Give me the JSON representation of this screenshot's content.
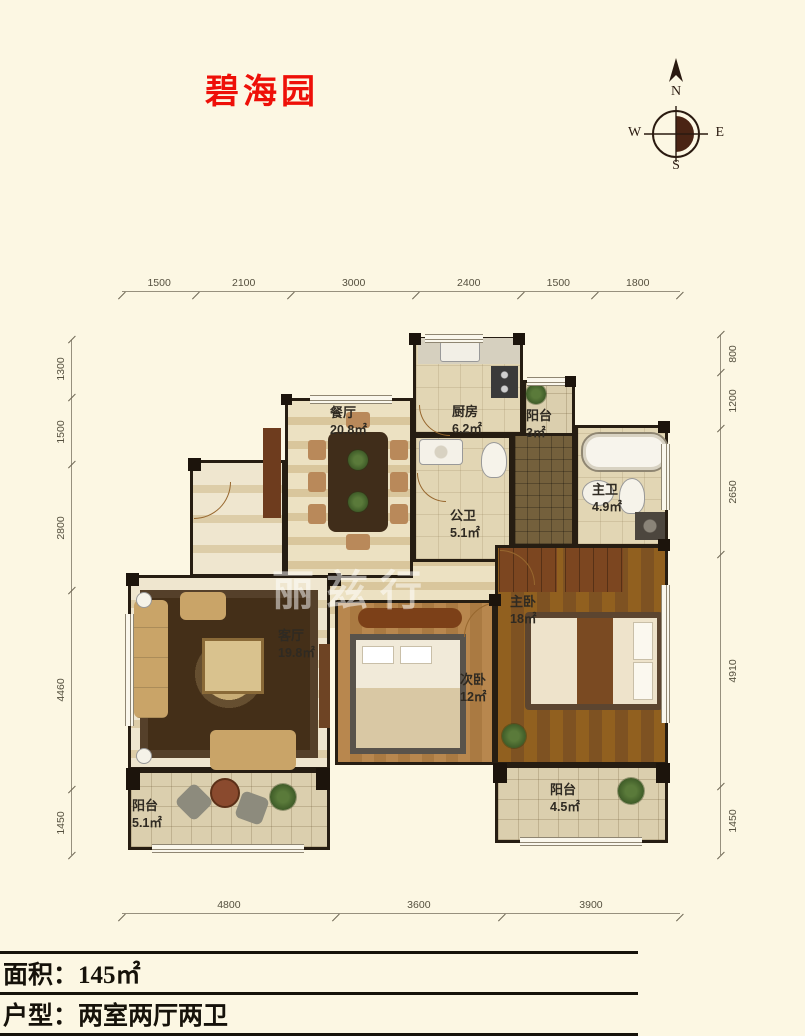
{
  "title": "碧海园",
  "compass": {
    "north": "N",
    "south": "S",
    "east": "E",
    "west": "W"
  },
  "dimensions": {
    "top": [
      "1500",
      "2100",
      "3000",
      "2400",
      "1500",
      "1800"
    ],
    "bottom": [
      "4800",
      "3600",
      "3900"
    ],
    "left": [
      "1300",
      "1500",
      "2800",
      "4460",
      "1450"
    ],
    "right": [
      "800",
      "1200",
      "2650",
      "4910",
      "1450"
    ]
  },
  "rooms": {
    "dining": {
      "name": "餐厅",
      "area": "20.8㎡"
    },
    "kitchen": {
      "name": "厨房",
      "area": "6.2㎡"
    },
    "balcony_north": {
      "name": "阳台",
      "area": "3㎡"
    },
    "master_bath": {
      "name": "主卫",
      "area": "4.9㎡"
    },
    "guest_bath": {
      "name": "公卫",
      "area": "5.1㎡"
    },
    "master_bedroom": {
      "name": "主卧",
      "area": "18㎡"
    },
    "living_room": {
      "name": "客厅",
      "area": "19.8㎡"
    },
    "second_bedroom": {
      "name": "次卧",
      "area": "12㎡"
    },
    "balcony_southwest": {
      "name": "阳台",
      "area": "5.1㎡"
    },
    "balcony_southeast": {
      "name": "阳台",
      "area": "4.5㎡"
    }
  },
  "watermark": "丽兹行",
  "footer": {
    "area": "面积：145㎡",
    "layout": "户型：两室两厅两卫"
  },
  "colors": {
    "background": "#fcf7e3",
    "title": "#ee1008",
    "wall": "#261d12",
    "dim_text": "#55503f"
  }
}
